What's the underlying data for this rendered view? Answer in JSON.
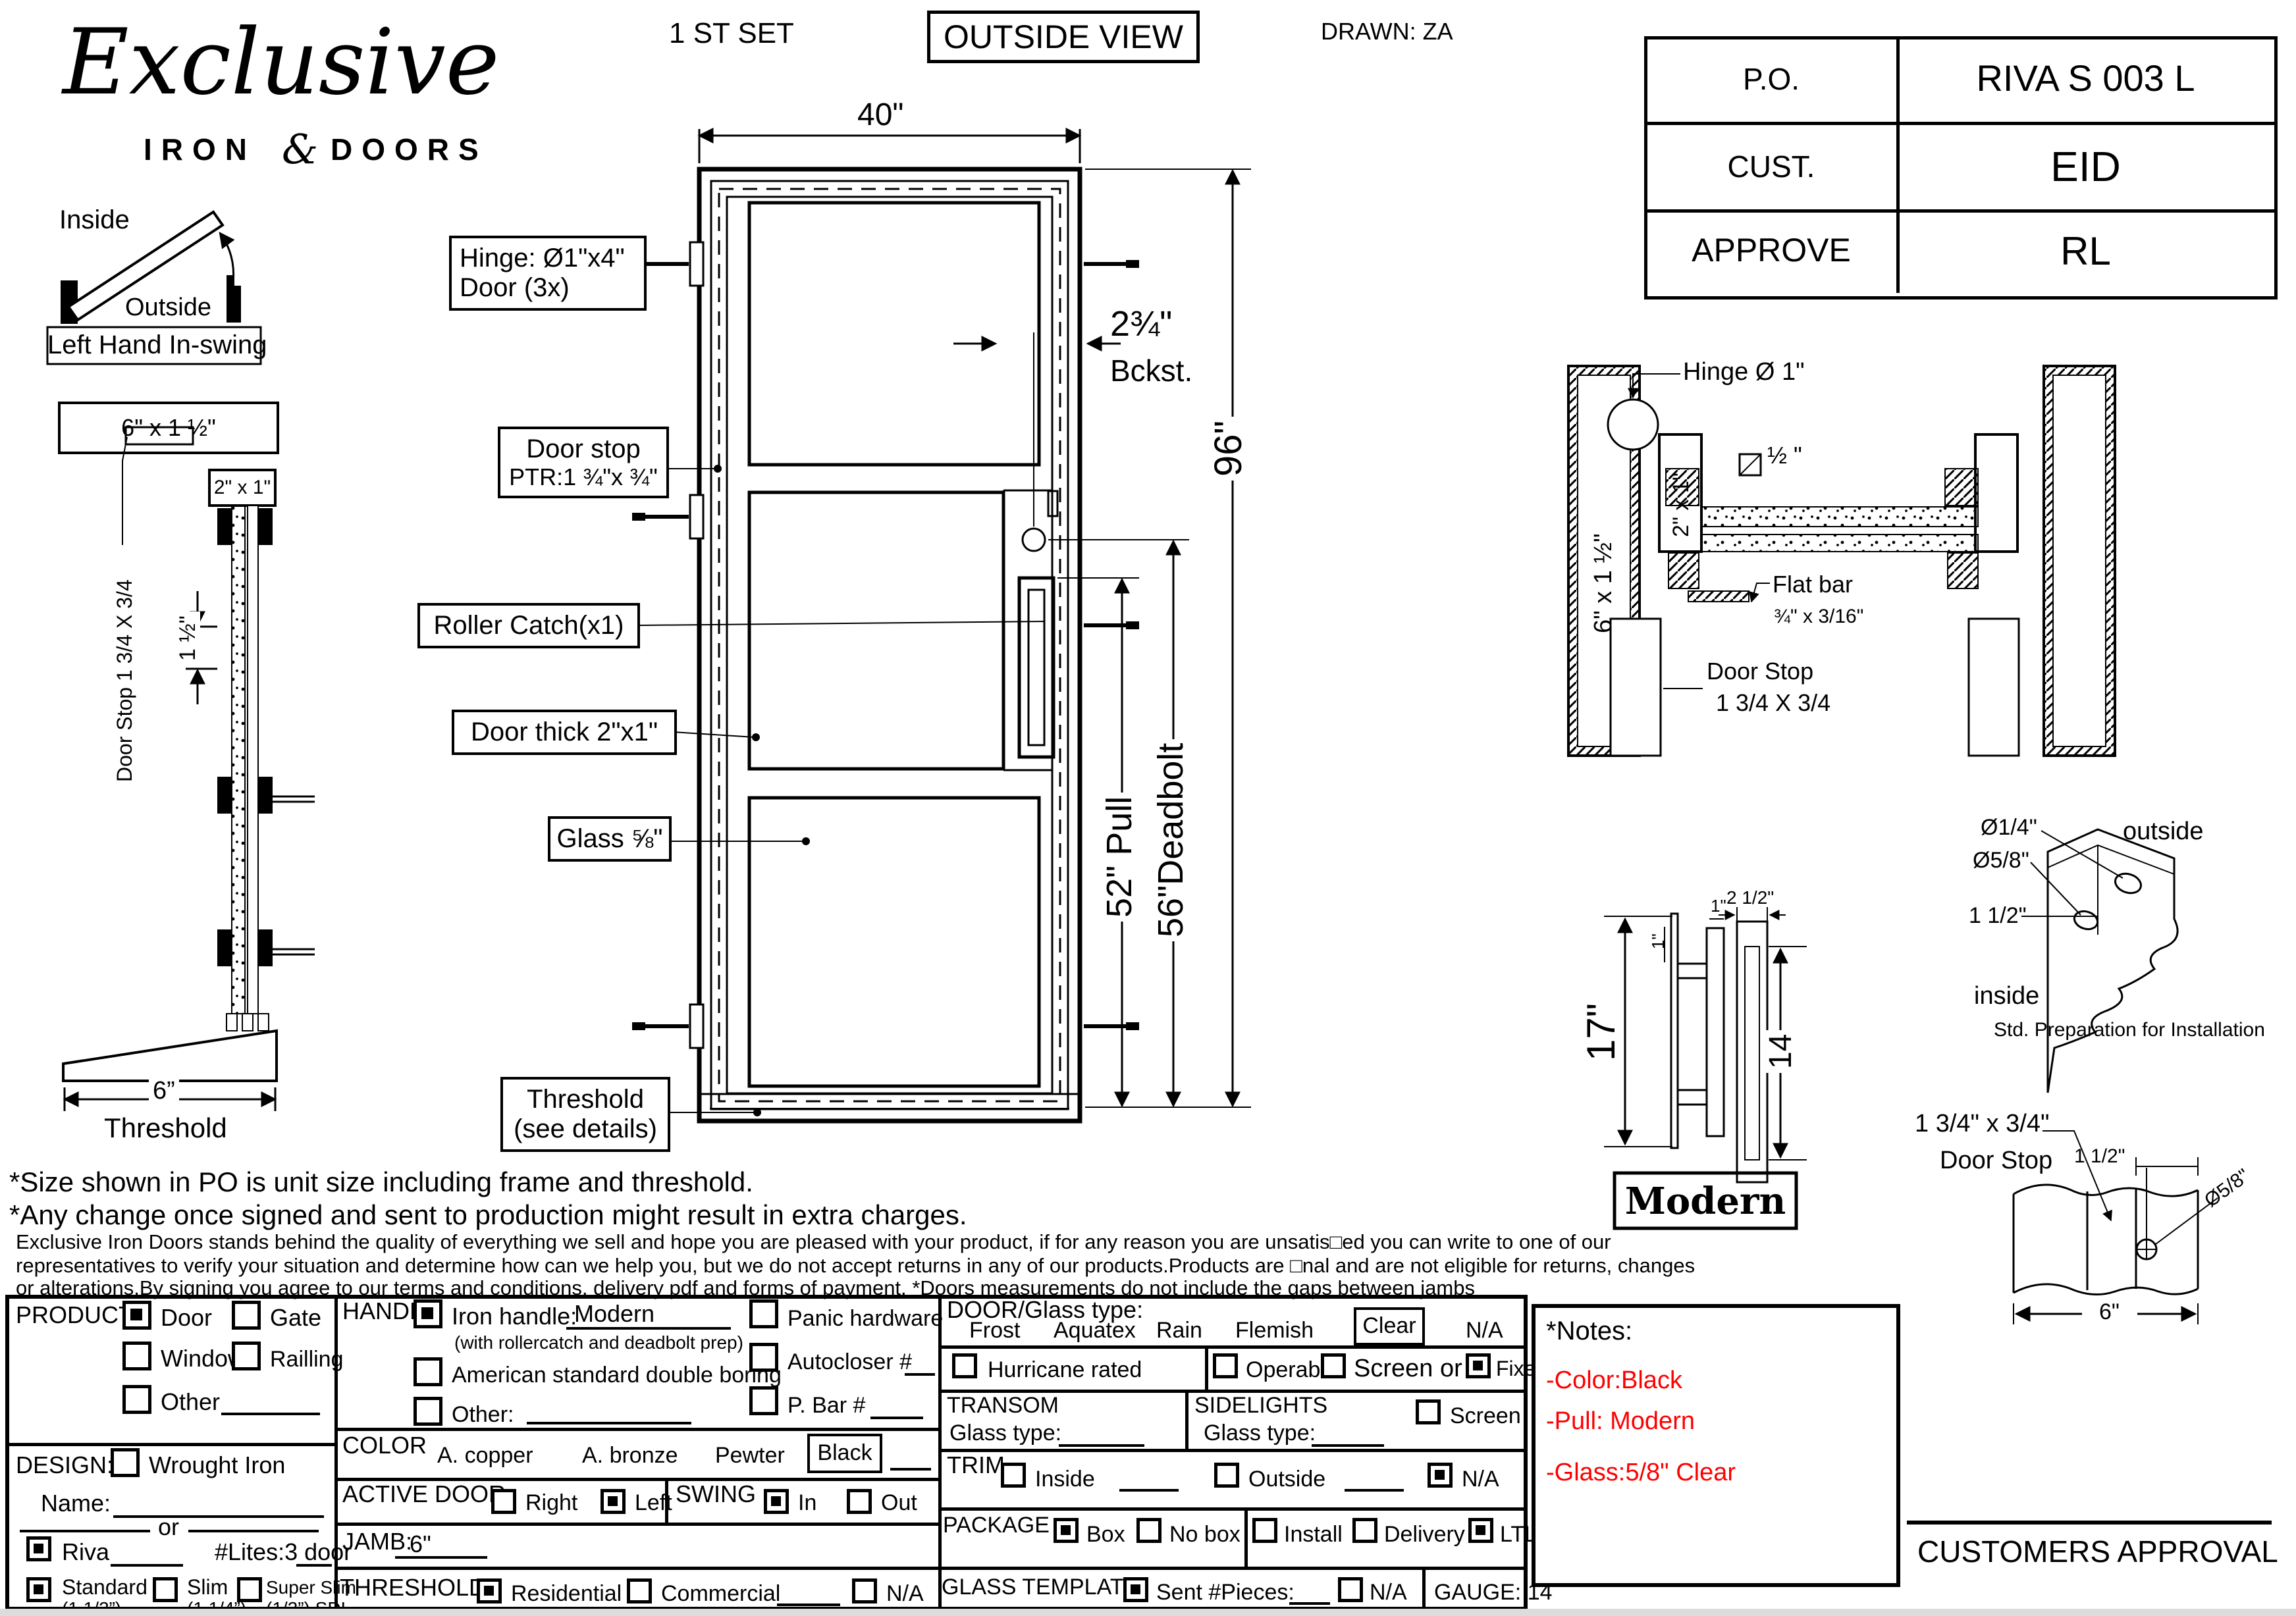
{
  "header": {
    "logo_script": "Exclusive",
    "logo_iron": "IRON",
    "logo_amp": "&",
    "logo_doors": "DOORS",
    "set_label": "1 ST SET",
    "view_label": "OUTSIDE VIEW",
    "drawn": "DRAWN: ZA",
    "po_table": {
      "rows": [
        {
          "label": "P.O.",
          "value": "RIVA S 003 L"
        },
        {
          "label": "CUST.",
          "value": "EID"
        },
        {
          "label": "APPROVE",
          "value": "RL"
        }
      ]
    }
  },
  "swing": {
    "inside": "Inside",
    "outside": "Outside",
    "caption": "Left Hand In-swing"
  },
  "left_section": {
    "header_size": "6\" x 1 ½\"",
    "tube_size": "2\" x 1\"",
    "door_stop": "Door Stop 1 3/4 X 3/4",
    "dim_gap": "1 ½\"",
    "dim_width": "6”",
    "caption": "Threshold"
  },
  "door": {
    "dim_width": "40\"",
    "dim_height": "96\"",
    "dim_backset1": "2¾\"",
    "dim_backset2": "Bckst.",
    "dim_pull": "52\" Pull",
    "dim_deadbolt": "56\"Deadbolt",
    "label_hinge1": "Hinge: Ø1\"x4\"",
    "label_hinge2": "Door (3x)",
    "label_doorstop1": "Door stop",
    "label_doorstop2": "PTR:1 ¾\"x ¾\"",
    "label_roller": "Roller Catch(x1)",
    "label_thick": "Door thick 2\"x1\"",
    "label_glass": "Glass ⅝\"",
    "label_threshold1": "Threshold",
    "label_threshold2": "(see details)"
  },
  "jamb_section": {
    "hinge": "Hinge  Ø 1\"",
    "jamb_size": "6\" x 1 ½\"",
    "tube_size": "2\" x 1\"",
    "weld": "½ \"",
    "flat_bar1": "Flat bar",
    "flat_bar2": "¾\" x 3/16\"",
    "door_stop1": "Door Stop",
    "door_stop2": "1 3/4 X 3/4"
  },
  "handle": {
    "dim_h": "17\"",
    "dim_1a": "1\"",
    "dim_1b": "1\"",
    "dim_w": "2 1/2\"",
    "dim_grip": "14",
    "name": "Modern"
  },
  "install": {
    "d1": "Ø1/4\"",
    "d2": "Ø5/8\"",
    "d3": "1 1/2\"",
    "outside": "outside",
    "inside": "inside",
    "caption": "Std. Preparation for Installation"
  },
  "stop_detail": {
    "size": "1 3/4\" x 3/4\"",
    "name": "Door Stop",
    "dim1": "1 1/2\"",
    "dim2": "Ø5/8\"",
    "dim3": "6\""
  },
  "disclaimer": {
    "line1": "*Size shown in PO is unit size including frame and threshold.",
    "line2": "*Any change once signed and sent to production might result in extra charges.",
    "line3": "Exclusive Iron Doors stands behind the quality of everything we sell and hope you are pleased with your product, if for any reason you are unsatis□ed you can write to one of our",
    "line4": "representatives to verify your situation and determine how can we help you, but we do not accept returns in any of our products.Products are □nal and are not eligible for returns, changes",
    "line5": "or alterations.By signing you agree to our terms and conditions, delivery pdf and forms of payment. *Doors measurements do not include the gaps between jambs"
  },
  "form": {
    "product": {
      "title": "PRODUCT:",
      "door": {
        "label": "Door",
        "checked": true
      },
      "gate": {
        "label": "Gate",
        "checked": false
      },
      "window": {
        "label": "Window",
        "checked": false
      },
      "railing": {
        "label": "Railling",
        "checked": false
      },
      "other": {
        "label": "Other",
        "checked": false
      }
    },
    "design": {
      "title": "DESIGN:",
      "wrought": {
        "label": "Wrought Iron",
        "checked": false
      },
      "name_label": "Name:",
      "or_label": "or",
      "riva": {
        "label": "Riva",
        "checked": true
      },
      "lites_label": "#Lites:3  door",
      "standard": {
        "label": "Standard",
        "sub": "(1 1/2”)",
        "checked": true
      },
      "slim": {
        "label": "Slim",
        "sub": "(1 1/4”)",
        "checked": false
      },
      "super_slim": {
        "label": "Super Slim",
        "sub": "(1/2”) SDL",
        "checked": false
      }
    },
    "handle": {
      "title": "HANDLE",
      "iron": {
        "label": "Iron handle:",
        "value": "Modern",
        "checked": true
      },
      "iron_note": "(with rollercatch and deadbolt prep)",
      "american": {
        "label": "American standard double boring",
        "checked": false
      },
      "other": {
        "label": "Other:",
        "checked": false
      },
      "panic": {
        "label": "Panic hardware",
        "checked": false
      },
      "autocloser": {
        "label": "Autocloser #",
        "checked": false
      },
      "pbar": {
        "label": "P. Bar #",
        "checked": false
      }
    },
    "color": {
      "title": "COLOR",
      "copper": "A. copper",
      "bronze": "A. bronze",
      "pewter": "Pewter",
      "selected": "Black"
    },
    "active_door": {
      "title": "ACTIVE DOOR",
      "right": {
        "label": "Right",
        "checked": false
      },
      "left": {
        "label": "Left",
        "checked": true
      }
    },
    "swing": {
      "title": "SWING",
      "in_opt": {
        "label": "In",
        "checked": true
      },
      "out_opt": {
        "label": "Out",
        "checked": false
      }
    },
    "jamb": {
      "title": "JAMB:",
      "value": "6\""
    },
    "threshold": {
      "title": "THRESHOLD",
      "residential": {
        "label": "Residential",
        "checked": true
      },
      "commercial": {
        "label": "Commercial",
        "checked": false
      },
      "na": {
        "label": "N/A",
        "checked": false
      }
    },
    "door_glass": {
      "title": "DOOR/Glass type:",
      "frost": "Frost",
      "aquatex": "Aquatex",
      "rain": "Rain",
      "flemish": "Flemish",
      "selected": "Clear",
      "na": "N/A"
    },
    "hurricane": {
      "label": "Hurricane rated",
      "checked": false
    },
    "opening": {
      "operable": {
        "label": "Operable",
        "checked": false
      },
      "screen_or": {
        "label": "Screen or",
        "checked": false
      },
      "fixed": {
        "label": "Fixed",
        "checked": true
      }
    },
    "transom": {
      "title": "TRANSOM",
      "glass_label": "Glass type:"
    },
    "sidelights": {
      "title": "SIDELIGHTS",
      "glass_label": "Glass type:",
      "screen": {
        "label": "Screen",
        "checked": false
      }
    },
    "trim": {
      "title": "TRIM",
      "inside": {
        "label": "Inside",
        "checked": false
      },
      "outside": {
        "label": "Outside",
        "checked": false
      },
      "na": {
        "label": "N/A",
        "checked": true
      }
    },
    "package": {
      "title": "PACKAGE",
      "box": {
        "label": "Box",
        "checked": true
      },
      "nobox": {
        "label": "No box",
        "checked": false
      },
      "install": {
        "label": "Install",
        "checked": false
      },
      "delivery": {
        "label": "Delivery",
        "checked": false
      },
      "ltl": {
        "label": "LTL",
        "checked": true
      }
    },
    "glass_template": {
      "title": "GLASS TEMPLATE",
      "sent": {
        "label": "Sent #Pieces:",
        "checked": true
      },
      "na": {
        "label": "N/A",
        "checked": false
      },
      "gauge": "GAUGE: 14"
    }
  },
  "notes": {
    "title": "*Notes:",
    "color": "#ff0000",
    "items": [
      "-Color:Black",
      "-Pull: Modern",
      "-Glass:5/8\" Clear"
    ]
  },
  "approval": "CUSTOMERS APPROVAL"
}
